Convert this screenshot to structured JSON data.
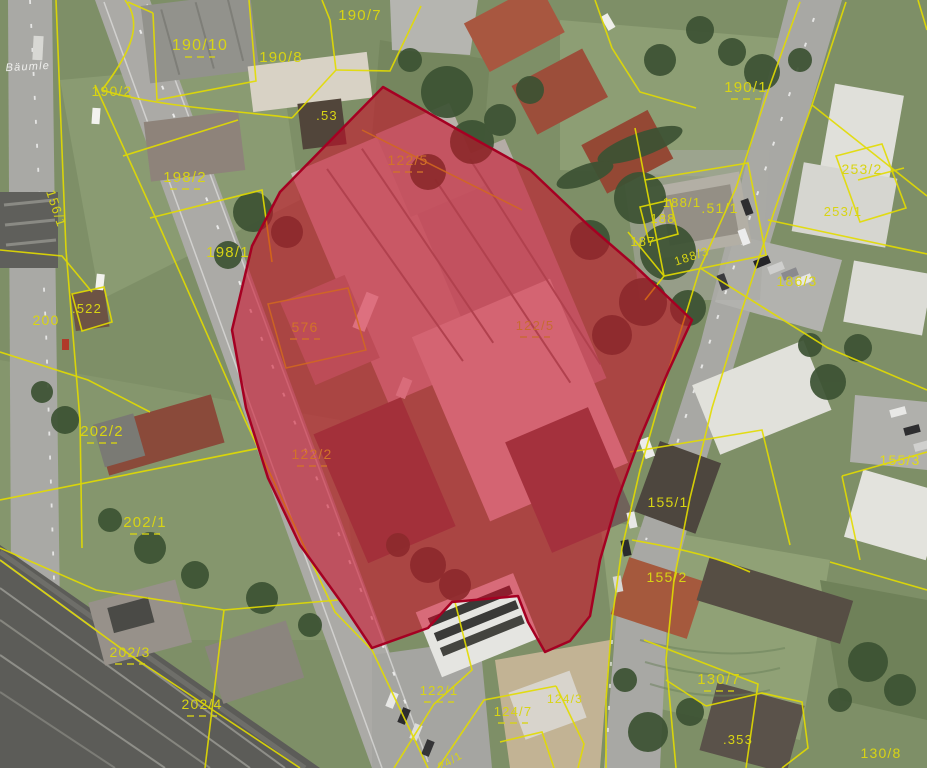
{
  "map": {
    "description": "Aerial cadastral map with parcel boundaries and one highlighted (selected) parcel",
    "overlay": {
      "name": "selected-parcel",
      "fill": "#cd0a28",
      "opacity": 0.56,
      "border": "#a50022"
    },
    "line_colors": {
      "parcel_line": "#e3dc00",
      "parcel_line_inside_overlay": "#d2691e"
    },
    "labels": [
      {
        "text": "Bäumle",
        "x": 28,
        "y": 70,
        "size": 11,
        "color": "#f0f0ee",
        "italic": true,
        "rot": -3,
        "dash": false,
        "kind": "street"
      },
      {
        "text": "190/2",
        "x": 112,
        "y": 96,
        "size": 14,
        "color": "#d8d414",
        "dash": false
      },
      {
        "text": "190/10",
        "x": 200,
        "y": 50,
        "size": 16,
        "color": "#d8d414",
        "dash": true
      },
      {
        "text": "190/7",
        "x": 360,
        "y": 20,
        "size": 15,
        "color": "#d8d414",
        "dash": false
      },
      {
        "text": "190/8",
        "x": 281,
        "y": 62,
        "size": 15,
        "color": "#d8d414",
        "dash": false
      },
      {
        "text": ".53",
        "x": 327,
        "y": 120,
        "size": 13,
        "color": "#d8d414",
        "dash": false
      },
      {
        "text": "122/5",
        "x": 408,
        "y": 165,
        "size": 14,
        "color": "#d2722a",
        "dash": true
      },
      {
        "text": "122/5",
        "x": 535,
        "y": 330,
        "size": 13,
        "color": "#c86a32",
        "dash": true
      },
      {
        "text": "190/1",
        "x": 746,
        "y": 92,
        "size": 15,
        "color": "#d8d414",
        "dash": true
      },
      {
        "text": "253/2",
        "x": 862,
        "y": 174,
        "size": 14,
        "color": "#d8d414",
        "dash": false
      },
      {
        "text": "253/1",
        "x": 843,
        "y": 216,
        "size": 13,
        "color": "#d8d414",
        "dash": false
      },
      {
        "text": "188/1",
        "x": 682,
        "y": 207,
        "size": 13,
        "color": "#d8d414",
        "dash": false
      },
      {
        "text": ".51/1",
        "x": 720,
        "y": 213,
        "size": 14,
        "color": "#d8d414",
        "dash": false
      },
      {
        "text": "188",
        "x": 663,
        "y": 223,
        "size": 13,
        "color": "#d8d414",
        "dash": false
      },
      {
        "text": "187",
        "x": 643,
        "y": 246,
        "size": 13,
        "color": "#d8d414",
        "dash": false
      },
      {
        "text": "188/3",
        "x": 693,
        "y": 260,
        "size": 12,
        "color": "#d8d414",
        "rot": -18,
        "dash": false
      },
      {
        "text": "186/3",
        "x": 797,
        "y": 286,
        "size": 14,
        "color": "#d8d414",
        "dash": false
      },
      {
        "text": "198/2",
        "x": 185,
        "y": 182,
        "size": 15,
        "color": "#d8d414",
        "dash": true
      },
      {
        "text": "198/1",
        "x": 228,
        "y": 257,
        "size": 15,
        "color": "#d8d414",
        "dash": false
      },
      {
        "text": "156/1",
        "x": 52,
        "y": 210,
        "size": 13,
        "color": "#d8d414",
        "rot": 72,
        "dash": false
      },
      {
        "text": "200",
        "x": 46,
        "y": 325,
        "size": 14,
        "color": "#d8d414",
        "dash": false
      },
      {
        "text": ".522",
        "x": 87,
        "y": 313,
        "size": 13,
        "color": "#d8d414",
        "dash": false
      },
      {
        "text": "576",
        "x": 305,
        "y": 332,
        "size": 14,
        "color": "#d2722a",
        "dash": true
      },
      {
        "text": "122/2",
        "x": 312,
        "y": 459,
        "size": 14,
        "color": "#d2722a",
        "dash": true
      },
      {
        "text": "202/2",
        "x": 102,
        "y": 436,
        "size": 15,
        "color": "#d8d414",
        "dash": true
      },
      {
        "text": "202/1",
        "x": 145,
        "y": 527,
        "size": 15,
        "color": "#d8d414",
        "dash": true
      },
      {
        "text": "202/3",
        "x": 130,
        "y": 657,
        "size": 14,
        "color": "#d8d414",
        "dash": true
      },
      {
        "text": "202/4",
        "x": 202,
        "y": 709,
        "size": 14,
        "color": "#d8d414",
        "dash": true
      },
      {
        "text": "155/3",
        "x": 900,
        "y": 465,
        "size": 14,
        "color": "#e0da1a",
        "dash": false
      },
      {
        "text": "155/1",
        "x": 668,
        "y": 507,
        "size": 14,
        "color": "#d8d414",
        "dash": false
      },
      {
        "text": "155/2",
        "x": 667,
        "y": 582,
        "size": 14,
        "color": "#d8d414",
        "dash": false
      },
      {
        "text": "130/7",
        "x": 719,
        "y": 684,
        "size": 15,
        "color": "#d8d414",
        "dash": true
      },
      {
        "text": ".353",
        "x": 738,
        "y": 744,
        "size": 13,
        "color": "#d8d414",
        "dash": false
      },
      {
        "text": "130/8",
        "x": 881,
        "y": 758,
        "size": 14,
        "color": "#d8d414",
        "dash": false
      },
      {
        "text": "122/1",
        "x": 439,
        "y": 695,
        "size": 13,
        "color": "#d8d414",
        "dash": true
      },
      {
        "text": "124/7",
        "x": 513,
        "y": 716,
        "size": 13,
        "color": "#d8d414",
        "dash": true
      },
      {
        "text": "124/3",
        "x": 565,
        "y": 703,
        "size": 12,
        "color": "#d8d414",
        "dash": false
      },
      {
        "text": "24/1",
        "x": 452,
        "y": 764,
        "size": 11,
        "color": "#d8d414",
        "rot": -30,
        "dash": false
      }
    ]
  }
}
